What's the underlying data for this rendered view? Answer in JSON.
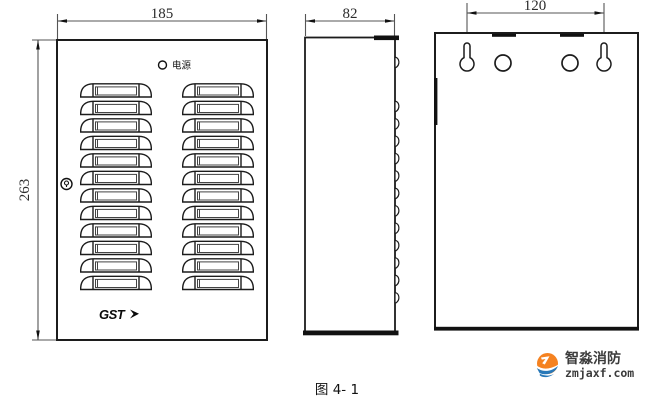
{
  "figure": {
    "caption": "图 4- 1"
  },
  "front_view": {
    "width_dim": "185",
    "height_dim": "263",
    "power_led_label": "电源",
    "brand_logo": "GST",
    "vent_rows": 12,
    "vent_columns": 2,
    "vent_col_x": [
      80,
      182
    ],
    "vent_row_start_y": 83,
    "vent_row_spacing": 17.5
  },
  "side_view": {
    "width_dim": "82",
    "louver_bumps": 12,
    "bump_start_y": 101,
    "bump_spacing": 17.4,
    "bump_edge_x": 395
  },
  "back_view": {
    "hole_spacing_dim": "120"
  },
  "watermark": {
    "brand": "智淼消防",
    "site": "zmjaxf.com",
    "orange": "#f58220",
    "blue": "#2878b8"
  },
  "colors": {
    "line": "#1c1c1c",
    "dim_line": "#555555",
    "arrow": "#111111",
    "background": "#ffffff"
  }
}
